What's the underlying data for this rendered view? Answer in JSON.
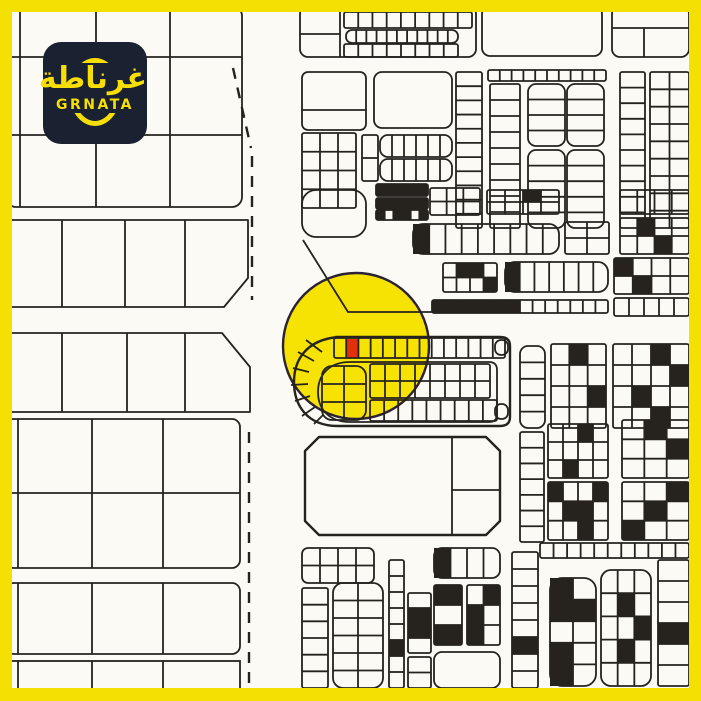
{
  "frame": {
    "color": "#F5E003",
    "thickness": 12
  },
  "logo": {
    "arabic": "غرناطة",
    "latin": "GRNATA",
    "bg": "#1A2130",
    "accent": "#F7DF05"
  },
  "map": {
    "bg": "#FBFAF5",
    "ink": "#26231F",
    "highlight_circle": {
      "cx": 356,
      "cy": 346,
      "r": 73,
      "fill": "#F6E203",
      "stroke": "#2B2335"
    },
    "selected_plot": {
      "x": 346.5,
      "y": 339,
      "w": 12,
      "h": 19,
      "color": "#E23008"
    },
    "shapes": [
      {
        "t": "rect",
        "x": 6,
        "y": 6,
        "w": 236,
        "h": 201,
        "r": 10
      },
      {
        "t": "line",
        "x1": 12,
        "y1": 57,
        "x2": 242,
        "y2": 57
      },
      {
        "t": "line",
        "x1": 12,
        "y1": 135,
        "x2": 242,
        "y2": 135
      },
      {
        "t": "line",
        "x1": 20,
        "y1": 10,
        "x2": 20,
        "y2": 207
      },
      {
        "t": "line",
        "x1": 96,
        "y1": 10,
        "x2": 96,
        "y2": 207
      },
      {
        "t": "line",
        "x1": 170,
        "y1": 10,
        "x2": 170,
        "y2": 207
      },
      {
        "t": "path",
        "d": "M6,220 H248 V278 L224,307 H6"
      },
      {
        "t": "line",
        "x1": 62,
        "y1": 220,
        "x2": 62,
        "y2": 307
      },
      {
        "t": "line",
        "x1": 125,
        "y1": 220,
        "x2": 125,
        "y2": 307
      },
      {
        "t": "line",
        "x1": 185,
        "y1": 220,
        "x2": 185,
        "y2": 307
      },
      {
        "t": "path",
        "d": "M6,333 H222 L250,367 V412 H6"
      },
      {
        "t": "line",
        "x1": 62,
        "y1": 333,
        "x2": 62,
        "y2": 412
      },
      {
        "t": "line",
        "x1": 127,
        "y1": 333,
        "x2": 127,
        "y2": 412
      },
      {
        "t": "line",
        "x1": 185,
        "y1": 333,
        "x2": 185,
        "y2": 412
      },
      {
        "t": "rect",
        "x": 6,
        "y": 419,
        "w": 234,
        "h": 149,
        "r": 8
      },
      {
        "t": "line",
        "x1": 12,
        "y1": 493,
        "x2": 240,
        "y2": 493
      },
      {
        "t": "line",
        "x1": 18,
        "y1": 419,
        "x2": 18,
        "y2": 568
      },
      {
        "t": "line",
        "x1": 92,
        "y1": 419,
        "x2": 92,
        "y2": 568
      },
      {
        "t": "line",
        "x1": 163,
        "y1": 419,
        "x2": 163,
        "y2": 568
      },
      {
        "t": "rect",
        "x": 6,
        "y": 583,
        "w": 234,
        "h": 71,
        "r": 8
      },
      {
        "t": "line",
        "x1": 18,
        "y1": 583,
        "x2": 18,
        "y2": 654
      },
      {
        "t": "line",
        "x1": 92,
        "y1": 583,
        "x2": 92,
        "y2": 654
      },
      {
        "t": "line",
        "x1": 163,
        "y1": 583,
        "x2": 163,
        "y2": 654
      },
      {
        "t": "rect",
        "x": 6,
        "y": 661,
        "w": 234,
        "h": 34
      },
      {
        "t": "line",
        "x1": 18,
        "y1": 661,
        "x2": 18,
        "y2": 695
      },
      {
        "t": "line",
        "x1": 92,
        "y1": 661,
        "x2": 92,
        "y2": 695
      },
      {
        "t": "line",
        "x1": 163,
        "y1": 661,
        "x2": 163,
        "y2": 695
      },
      {
        "t": "dash",
        "x1": 233,
        "y1": 68,
        "x2": 251,
        "y2": 148
      },
      {
        "t": "dash",
        "x1": 252,
        "y1": 156,
        "x2": 252,
        "y2": 300
      },
      {
        "t": "dash",
        "x1": 249,
        "y1": 432,
        "x2": 249,
        "y2": 686
      },
      {
        "t": "rect",
        "x": 300,
        "y": 6,
        "w": 176,
        "h": 51,
        "r": 8
      },
      {
        "t": "line",
        "x1": 340,
        "y1": 6,
        "x2": 340,
        "y2": 57
      },
      {
        "t": "line",
        "x1": 300,
        "y1": 34,
        "x2": 340,
        "y2": 34
      },
      {
        "t": "ladder",
        "x": 344,
        "y": 12,
        "w": 128,
        "h": 16,
        "n": 9,
        "dir": "h"
      },
      {
        "t": "ladder",
        "x": 346,
        "y": 30,
        "w": 112,
        "h": 13,
        "n": 11,
        "dir": "h",
        "r": 6
      },
      {
        "t": "ladder",
        "x": 344,
        "y": 44,
        "w": 114,
        "h": 13,
        "n": 8,
        "dir": "h"
      },
      {
        "t": "rect",
        "x": 482,
        "y": 6,
        "w": 120,
        "h": 50,
        "r": 8
      },
      {
        "t": "rect",
        "x": 612,
        "y": 6,
        "w": 77,
        "h": 51,
        "r": 8
      },
      {
        "t": "line",
        "x1": 612,
        "y1": 28,
        "x2": 689,
        "y2": 28
      },
      {
        "t": "line",
        "x1": 644,
        "y1": 28,
        "x2": 644,
        "y2": 57
      },
      {
        "t": "rect",
        "x": 302,
        "y": 72,
        "w": 64,
        "h": 58,
        "r": 6
      },
      {
        "t": "line",
        "x1": 302,
        "y1": 110,
        "x2": 366,
        "y2": 110
      },
      {
        "t": "rect",
        "x": 374,
        "y": 72,
        "w": 78,
        "h": 56,
        "r": 8
      },
      {
        "t": "ladder",
        "x": 456,
        "y": 72,
        "w": 26,
        "h": 156,
        "n": 11,
        "dir": "v"
      },
      {
        "t": "grid",
        "x": 302,
        "y": 133,
        "w": 54,
        "h": 75,
        "cols": 3,
        "rows": 4
      },
      {
        "t": "grid",
        "x": 362,
        "y": 135,
        "w": 16,
        "h": 46,
        "cols": 1,
        "rows": 2
      },
      {
        "t": "ladder",
        "x": 380,
        "y": 135,
        "w": 72,
        "h": 22,
        "n": 6,
        "dir": "h",
        "r": 8
      },
      {
        "t": "ladder",
        "x": 380,
        "y": 159,
        "w": 72,
        "h": 22,
        "n": 6,
        "dir": "h",
        "r": 8
      },
      {
        "t": "ladder",
        "x": 376,
        "y": 184,
        "w": 52,
        "h": 12,
        "n": 6,
        "dir": "h",
        "fills": [
          0,
          1,
          2,
          3,
          4,
          5
        ]
      },
      {
        "t": "ladder",
        "x": 376,
        "y": 198,
        "w": 52,
        "h": 11,
        "n": 6,
        "dir": "h",
        "fills": [
          0,
          1,
          2,
          3,
          4,
          5
        ]
      },
      {
        "t": "ladder",
        "x": 376,
        "y": 210,
        "w": 52,
        "h": 10,
        "n": 6,
        "dir": "h",
        "fills": [
          0,
          2,
          3,
          5
        ]
      },
      {
        "t": "ladder",
        "x": 488,
        "y": 70,
        "w": 118,
        "h": 11,
        "n": 10,
        "dir": "h"
      },
      {
        "t": "ladder",
        "x": 490,
        "y": 84,
        "w": 30,
        "h": 144,
        "n": 9,
        "dir": "v"
      },
      {
        "t": "ladder",
        "x": 528,
        "y": 84,
        "w": 37,
        "h": 62,
        "n": 4,
        "dir": "v",
        "r": 8
      },
      {
        "t": "ladder",
        "x": 567,
        "y": 84,
        "w": 37,
        "h": 62,
        "n": 4,
        "dir": "v",
        "r": 8
      },
      {
        "t": "ladder",
        "x": 528,
        "y": 150,
        "w": 37,
        "h": 78,
        "n": 5,
        "dir": "v",
        "r": 8
      },
      {
        "t": "ladder",
        "x": 567,
        "y": 150,
        "w": 37,
        "h": 78,
        "n": 5,
        "dir": "v",
        "r": 8
      },
      {
        "t": "ladder",
        "x": 620,
        "y": 72,
        "w": 25,
        "h": 156,
        "n": 10,
        "dir": "v"
      },
      {
        "t": "grid",
        "x": 650,
        "y": 72,
        "w": 39,
        "h": 156,
        "cols": 2,
        "rows": 9
      },
      {
        "t": "rect",
        "x": 302,
        "y": 190,
        "w": 64,
        "h": 47,
        "r": 14
      },
      {
        "t": "grid",
        "x": 430,
        "y": 188,
        "w": 50,
        "h": 27,
        "cols": 3,
        "rows": 2
      },
      {
        "t": "grid",
        "x": 487,
        "y": 190,
        "w": 72,
        "h": 24,
        "cols": 4,
        "rows": 2,
        "fills": [
          2
        ]
      },
      {
        "t": "ladder",
        "x": 620,
        "y": 190,
        "w": 69,
        "h": 24,
        "n": 4,
        "dir": "h"
      },
      {
        "t": "ladder",
        "x": 413,
        "y": 224,
        "w": 146,
        "h": 30,
        "n": 9,
        "dir": "h",
        "r": 10,
        "fills": [
          0
        ]
      },
      {
        "t": "grid",
        "x": 565,
        "y": 222,
        "w": 44,
        "h": 32,
        "cols": 2,
        "rows": 2
      },
      {
        "t": "grid",
        "x": 620,
        "y": 218,
        "w": 69,
        "h": 36,
        "cols": 4,
        "rows": 2,
        "fills": [
          1,
          6
        ]
      },
      {
        "t": "grid",
        "x": 443,
        "y": 263,
        "w": 54,
        "h": 29,
        "cols": 4,
        "rows": 2,
        "fills": [
          1,
          2,
          7
        ]
      },
      {
        "t": "ladder",
        "x": 505,
        "y": 262,
        "w": 103,
        "h": 30,
        "n": 7,
        "dir": "h",
        "r": 10,
        "fills": [
          0
        ]
      },
      {
        "t": "grid",
        "x": 614,
        "y": 258,
        "w": 75,
        "h": 36,
        "cols": 4,
        "rows": 2,
        "fills": [
          0,
          5
        ]
      },
      {
        "t": "ladder",
        "x": 432,
        "y": 300,
        "w": 176,
        "h": 13,
        "n": 14,
        "dir": "h",
        "fills": [
          0,
          1,
          2,
          3,
          4,
          5,
          6
        ]
      },
      {
        "t": "ladder",
        "x": 614,
        "y": 298,
        "w": 75,
        "h": 18,
        "n": 5,
        "dir": "h"
      },
      {
        "t": "path",
        "d": "M303,240 L348,312 H434"
      },
      {
        "t": "path",
        "d": "M336,337 H500 Q510,337 510,346 V417 Q510,426 500,426 H338 C306,426 294,404 294,382 C294,360 306,340 338,337 Z",
        "sw": 2.4
      },
      {
        "t": "ladder",
        "x": 334,
        "y": 338,
        "w": 171,
        "h": 20,
        "n": 14,
        "dir": "h"
      },
      {
        "t": "line",
        "x1": 322,
        "y1": 352,
        "x2": 306,
        "y2": 340
      },
      {
        "t": "line",
        "x1": 314,
        "y1": 361,
        "x2": 298,
        "y2": 352
      },
      {
        "t": "line",
        "x1": 309,
        "y1": 372,
        "x2": 293,
        "y2": 368
      },
      {
        "t": "line",
        "x1": 308,
        "y1": 384,
        "x2": 291,
        "y2": 385
      },
      {
        "t": "line",
        "x1": 310,
        "y1": 396,
        "x2": 295,
        "y2": 401
      },
      {
        "t": "line",
        "x1": 315,
        "y1": 407,
        "x2": 302,
        "y2": 416
      },
      {
        "t": "line",
        "x1": 323,
        "y1": 415,
        "x2": 314,
        "y2": 424
      },
      {
        "t": "path",
        "d": "M350,362 H489 Q497,362 497,370 V414 Q497,422 489,422 H350 C330,422 318,410 318,392 C318,374 330,362 350,362 Z"
      },
      {
        "t": "grid",
        "x": 322,
        "y": 366,
        "w": 44,
        "h": 54,
        "cols": 2,
        "rows": 3,
        "r": 10
      },
      {
        "t": "grid",
        "x": 370,
        "y": 364,
        "w": 120,
        "h": 34,
        "cols": 8,
        "rows": 2
      },
      {
        "t": "ladder",
        "x": 370,
        "y": 400,
        "w": 127,
        "h": 21,
        "n": 9,
        "dir": "h"
      },
      {
        "t": "rect",
        "x": 495,
        "y": 340,
        "w": 13,
        "h": 15,
        "r": 6
      },
      {
        "t": "rect",
        "x": 495,
        "y": 404,
        "w": 13,
        "h": 15,
        "r": 6
      },
      {
        "t": "ladder",
        "x": 520,
        "y": 346,
        "w": 25,
        "h": 82,
        "n": 5,
        "dir": "v",
        "r": 8
      },
      {
        "t": "grid",
        "x": 551,
        "y": 344,
        "w": 55,
        "h": 84,
        "cols": 3,
        "rows": 4,
        "fills": [
          1,
          8
        ]
      },
      {
        "t": "grid",
        "x": 613,
        "y": 344,
        "w": 76,
        "h": 84,
        "cols": 4,
        "rows": 4,
        "fills": [
          2,
          7,
          9,
          14
        ]
      },
      {
        "t": "path",
        "d": "M319,437 H486 L500,451 V521 L486,535 H319 L305,521 V451 Z",
        "sw": 2.4
      },
      {
        "t": "line",
        "x1": 452,
        "y1": 437,
        "x2": 452,
        "y2": 535
      },
      {
        "t": "line",
        "x1": 452,
        "y1": 490,
        "x2": 500,
        "y2": 490
      },
      {
        "t": "ladder",
        "x": 520,
        "y": 432,
        "w": 24,
        "h": 110,
        "n": 7,
        "dir": "v"
      },
      {
        "t": "grid",
        "x": 548,
        "y": 424,
        "w": 60,
        "h": 54,
        "cols": 4,
        "rows": 3,
        "fills": [
          2,
          9
        ]
      },
      {
        "t": "grid",
        "x": 548,
        "y": 482,
        "w": 60,
        "h": 58,
        "cols": 4,
        "rows": 3,
        "fills": [
          0,
          3,
          5,
          6,
          10
        ]
      },
      {
        "t": "grid",
        "x": 622,
        "y": 420,
        "w": 67,
        "h": 58,
        "cols": 3,
        "rows": 3,
        "fills": [
          1,
          5
        ]
      },
      {
        "t": "grid",
        "x": 622,
        "y": 482,
        "w": 67,
        "h": 58,
        "cols": 3,
        "rows": 3,
        "fills": [
          2,
          4,
          6
        ]
      },
      {
        "t": "ladder",
        "x": 540,
        "y": 543,
        "w": 149,
        "h": 15,
        "n": 11,
        "dir": "h"
      },
      {
        "t": "grid",
        "x": 302,
        "y": 548,
        "w": 72,
        "h": 35,
        "cols": 4,
        "rows": 2,
        "r": 6
      },
      {
        "t": "ladder",
        "x": 302,
        "y": 588,
        "w": 26,
        "h": 100,
        "n": 6,
        "dir": "v"
      },
      {
        "t": "grid",
        "x": 333,
        "y": 583,
        "w": 50,
        "h": 105,
        "cols": 2,
        "rows": 6,
        "r": 10
      },
      {
        "t": "ladder",
        "x": 389,
        "y": 560,
        "w": 15,
        "h": 128,
        "n": 8,
        "dir": "v",
        "fills": [
          5
        ]
      },
      {
        "t": "ladder",
        "x": 408,
        "y": 593,
        "w": 23,
        "h": 60,
        "n": 4,
        "dir": "v",
        "fills": [
          1,
          2
        ]
      },
      {
        "t": "ladder",
        "x": 408,
        "y": 657,
        "w": 23,
        "h": 31,
        "n": 2,
        "dir": "v"
      },
      {
        "t": "grid",
        "x": 434,
        "y": 548,
        "w": 66,
        "h": 30,
        "cols": 4,
        "rows": 1,
        "r": 8,
        "fills": [
          0
        ]
      },
      {
        "t": "grid",
        "x": 434,
        "y": 585,
        "w": 28,
        "h": 60,
        "cols": 1,
        "rows": 3,
        "fills": [
          0,
          2
        ]
      },
      {
        "t": "grid",
        "x": 467,
        "y": 585,
        "w": 33,
        "h": 60,
        "cols": 2,
        "rows": 3,
        "fills": [
          1,
          2,
          4
        ]
      },
      {
        "t": "rect",
        "x": 434,
        "y": 652,
        "w": 66,
        "h": 36,
        "r": 8
      },
      {
        "t": "ladder",
        "x": 512,
        "y": 552,
        "w": 26,
        "h": 136,
        "n": 8,
        "dir": "v",
        "fills": [
          5
        ]
      },
      {
        "t": "grid",
        "x": 550,
        "y": 578,
        "w": 46,
        "h": 108,
        "cols": 2,
        "rows": 5,
        "r": 12,
        "fills": [
          0,
          2,
          3,
          6,
          8
        ]
      },
      {
        "t": "grid",
        "x": 601,
        "y": 570,
        "w": 50,
        "h": 116,
        "cols": 3,
        "rows": 5,
        "r": 10,
        "fills": [
          4,
          8,
          10
        ]
      },
      {
        "t": "ladder",
        "x": 658,
        "y": 560,
        "w": 31,
        "h": 126,
        "n": 6,
        "dir": "v",
        "fills": [
          3
        ]
      }
    ]
  }
}
